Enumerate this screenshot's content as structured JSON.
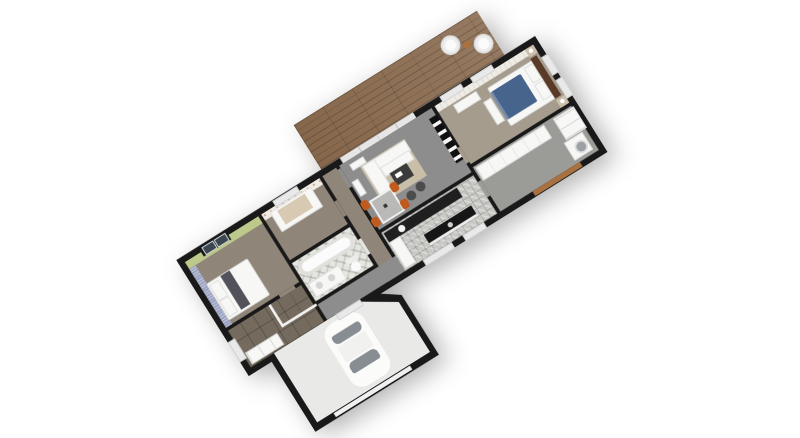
{
  "scene": {
    "type": "3d-isometric-floor-plan-render",
    "background": "#ffffff",
    "rotation_deg": -32,
    "no_visible_text": true
  },
  "colors": {
    "wall": "#191919",
    "taupe": "#8f8578",
    "taupe_light": "#a59c8e",
    "green": "#bcc98b",
    "blue": "#9aa2c2",
    "floral": "#f2ede3",
    "bath": "#e6e6e1",
    "tile_entry": "#746b5e",
    "gray": "#8d8d8d",
    "rug": "#c9bfa8",
    "mosaic": "#c8c8c4",
    "dark": "#1f1f1f",
    "garage": "#e9e9e7",
    "deck": "#86674b",
    "bed_blue": "#47648c",
    "orange": "#c05a1e",
    "wood": "#a9713f",
    "headboard": "#5a3b28"
  },
  "rooms": [
    {
      "name": "Bedroom 1"
    },
    {
      "name": "Nursery"
    },
    {
      "name": "Bathroom"
    },
    {
      "name": "Hallway"
    },
    {
      "name": "Entry"
    },
    {
      "name": "WC nook"
    },
    {
      "name": "Living / Dining room"
    },
    {
      "name": "Kitchen"
    },
    {
      "name": "Master bedroom"
    },
    {
      "name": "Dressing / Laundry"
    },
    {
      "name": "Garage"
    },
    {
      "name": "Wooden terrace"
    }
  ],
  "furniture": [
    "double bed",
    "crib",
    "bathtub",
    "vanity with basins",
    "toilet",
    "entry sideboard",
    "corner sofa",
    "coffee table",
    "floor poufs",
    "tv wall unit",
    "dining table",
    "orange chairs",
    "window benches",
    "kitchen counter",
    "kitchen island",
    "master bed",
    "nightstands with lamps",
    "wardrobes",
    "washing machine",
    "white car",
    "terrace poufs",
    "terrace stool"
  ]
}
